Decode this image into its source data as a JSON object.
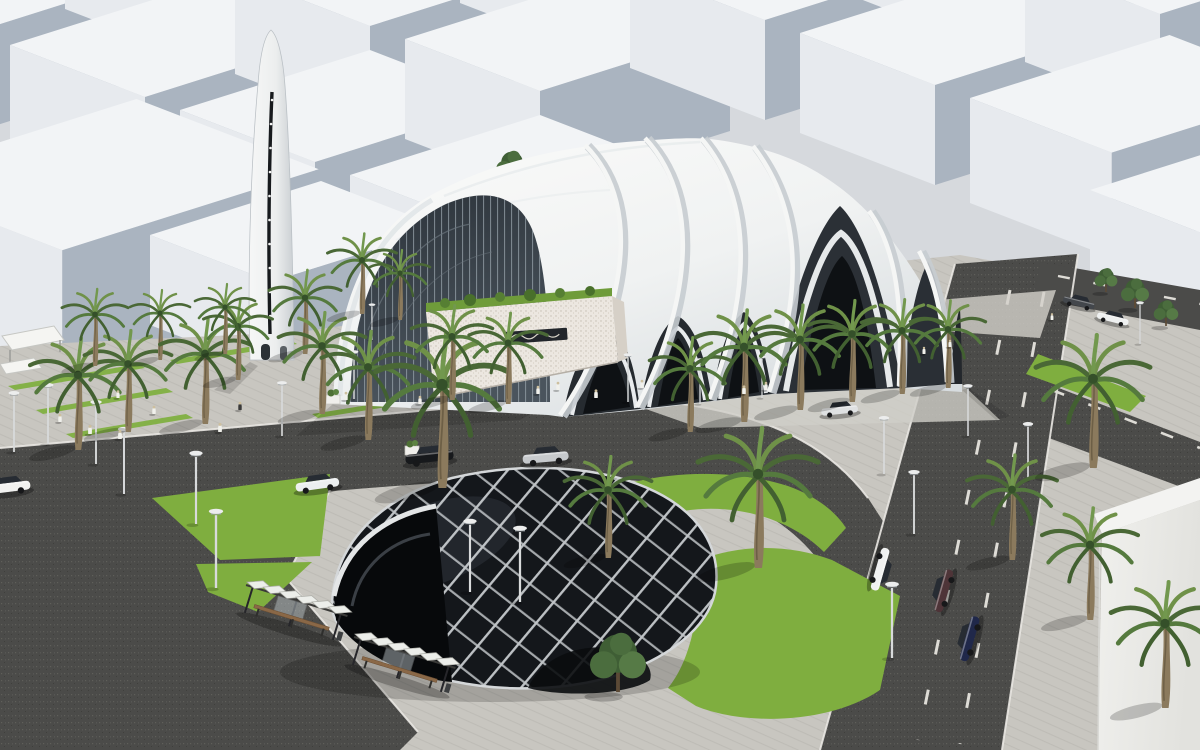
{
  "scene": {
    "title": "Aerial 3D architectural rendering of a modern mosque with a ribbed white shell roof and blade minaret, a black diagrid entrance pavilion, palm-lined plazas and roads, surrounded by white city massing blocks",
    "time_of_day": "daytime",
    "style": "3D architectural visualization, aerial three-quarter view",
    "buildings": {
      "mosque": {
        "label": "mosque with overlapping white shell ribs and pointed arch openings",
        "roof_color": "#f4f5f4",
        "shade_color": "#d7dcdf",
        "arch_interior_color": "#262b30",
        "glass_color": "#39424b",
        "stone_wall_color": "#ece7e0",
        "roof_garden_color": "#6f9c3a"
      },
      "minaret": {
        "label": "slender white blade minaret with vertical light slit",
        "color": "#f2f3f3",
        "slit_color": "#171a1d"
      },
      "diagrid_pavilion": {
        "label": "black glass dome pavilion with white diagonal grid",
        "glass_color": "#14171b",
        "frame_color": "#c6cacd"
      },
      "city_blocks": {
        "label": "white massing blocks of surrounding city",
        "top_color": "#f2f4f6",
        "front_color": "#e7eaee",
        "side_color": "#aab4c0",
        "count_visible": 16
      },
      "corner_building": {
        "label": "white building corner at bottom right",
        "color": "#ededea"
      }
    },
    "landscape": {
      "palm_trees": {
        "count": 27,
        "frond_color": "#557a3e",
        "trunk_color": "#8b7a5d"
      },
      "leafy_trees": {
        "count": 5,
        "color": "#3f5e35"
      },
      "lawns": {
        "color": "#7fae3f"
      },
      "pavers_color": "#c8c6c0",
      "asphalt_color": "#4b4b49"
    },
    "street_furniture": {
      "bus_shelters": {
        "count": 2,
        "label": "bus shelters with slatted canopies and benches"
      },
      "street_lamps": {
        "count": 20
      },
      "planters": {
        "count": 2
      },
      "canopies": {
        "count": 2,
        "label": "small white shade canopies in left plaza"
      }
    },
    "vehicles": {
      "count": 10,
      "colors": [
        "white",
        "white",
        "black",
        "silver",
        "silver",
        "dark-gray",
        "white",
        "white",
        "maroon",
        "navy"
      ]
    },
    "people": {
      "count": 18,
      "label": "pedestrians, mostly in white robes"
    }
  }
}
